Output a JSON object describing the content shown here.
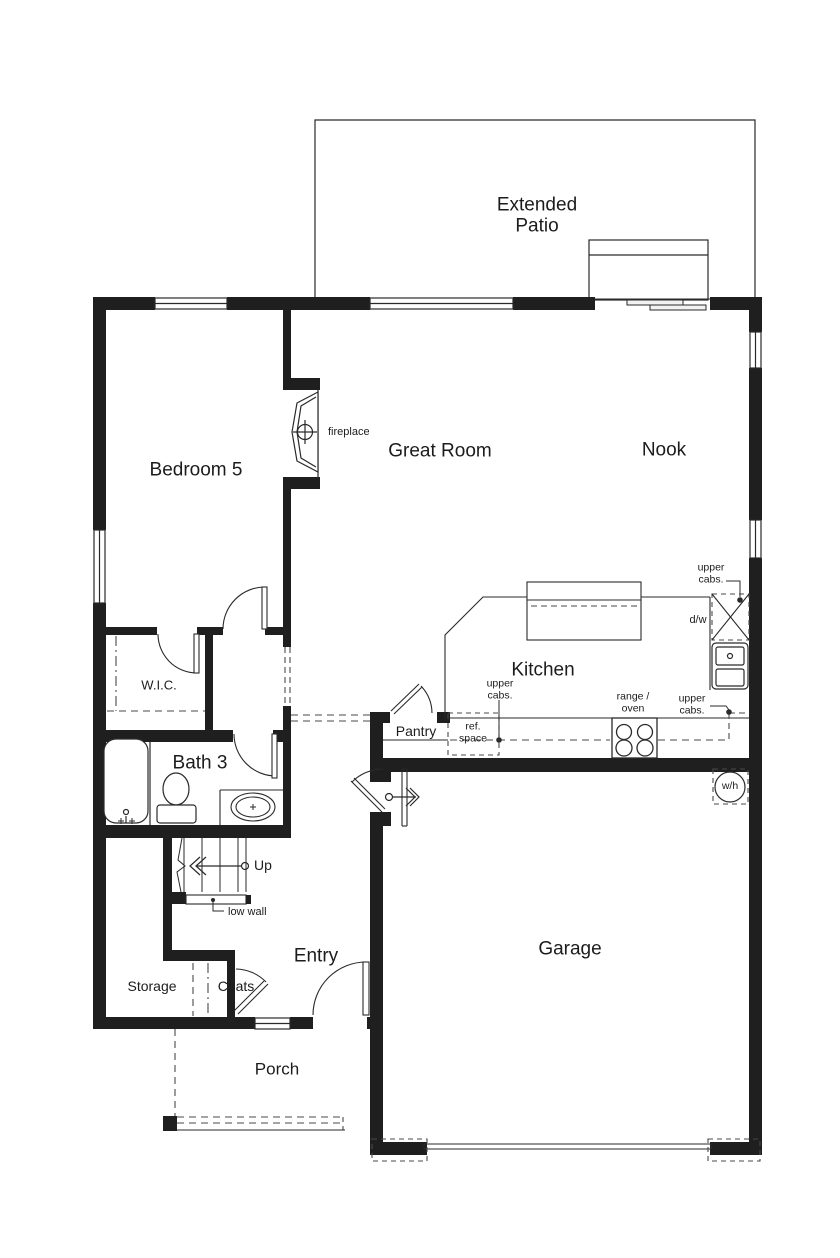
{
  "rooms": {
    "extended_patio": "Extended\nPatio",
    "bedroom5": "Bedroom 5",
    "great_room": "Great Room",
    "nook": "Nook",
    "kitchen": "Kitchen",
    "wic": "W.I.C.",
    "bath3": "Bath 3",
    "pantry": "Pantry",
    "entry": "Entry",
    "storage": "Storage",
    "coats": "Coats",
    "garage": "Garage",
    "porch": "Porch"
  },
  "annotations": {
    "fireplace": "fireplace",
    "upper_cabs_dw": "upper\ncabs.",
    "dw": "d/w",
    "upper_cabs_ref": "upper\ncabs.",
    "ref_space": "ref.\nspace",
    "range_oven": "range /\noven",
    "upper_cabs_right": "upper\ncabs.",
    "water_heater": "w/h",
    "stairs_up": "Up",
    "low_wall": "low wall"
  },
  "colors": {
    "wall": "#1f1f1f",
    "line": "#2a2a2a",
    "dashed": "#4a4a4a",
    "text": "#1c1c1c",
    "background": "#ffffff"
  }
}
